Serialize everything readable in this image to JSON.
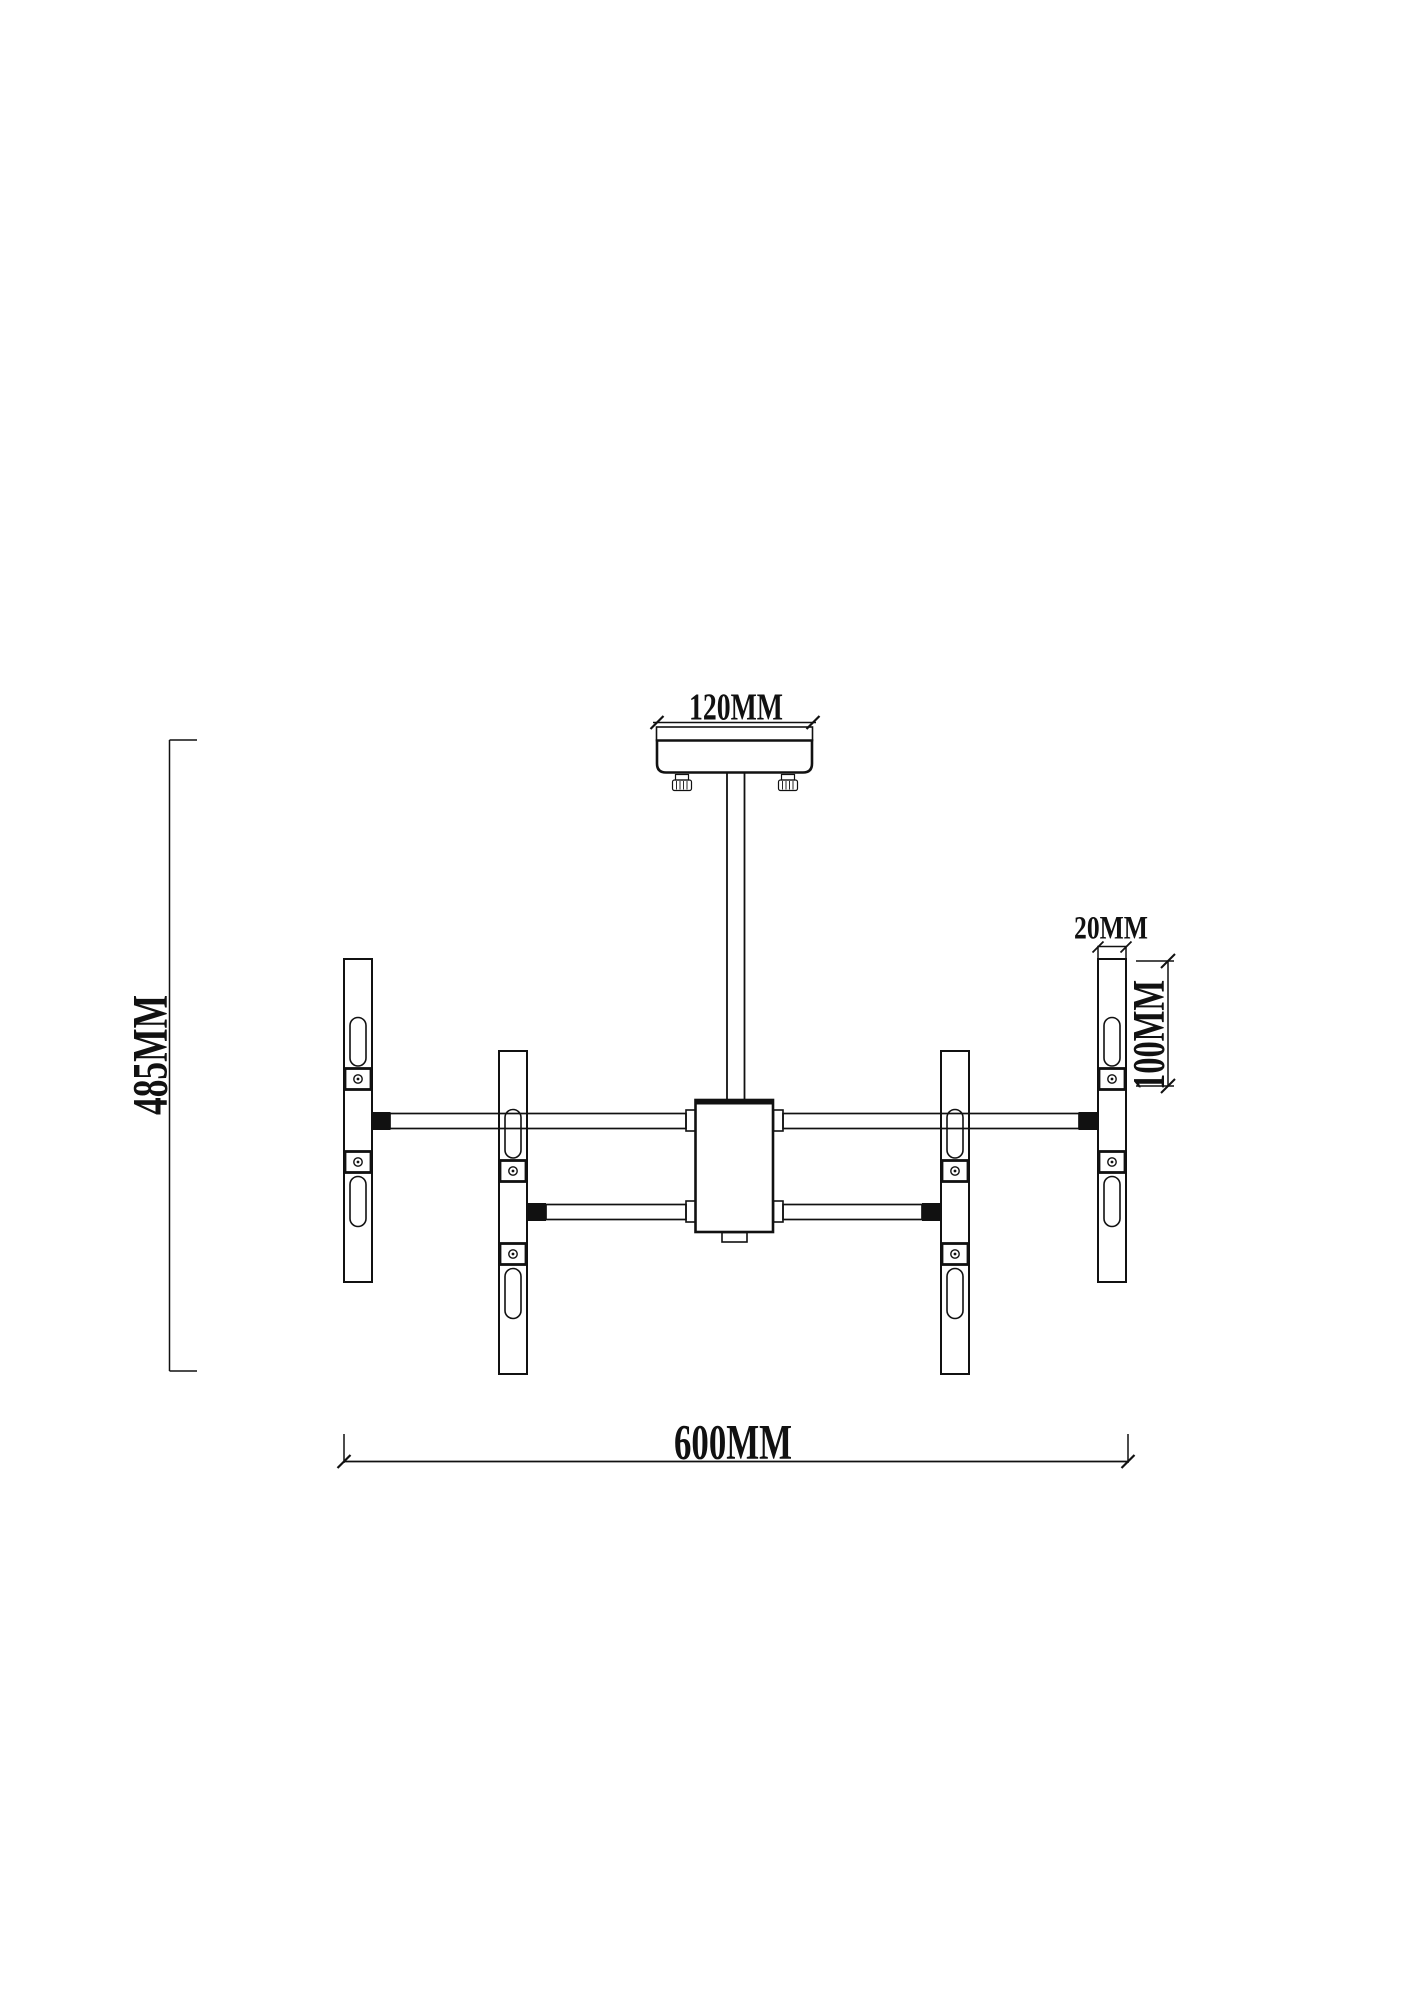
{
  "dimensions": {
    "canopy_width": "120MM",
    "overall_height": "485MM",
    "tube_diameter": "20MM",
    "lamp_section_length": "100MM",
    "overall_width": "600MM"
  },
  "colors": {
    "ink": "#111111",
    "background": "#ffffff"
  }
}
